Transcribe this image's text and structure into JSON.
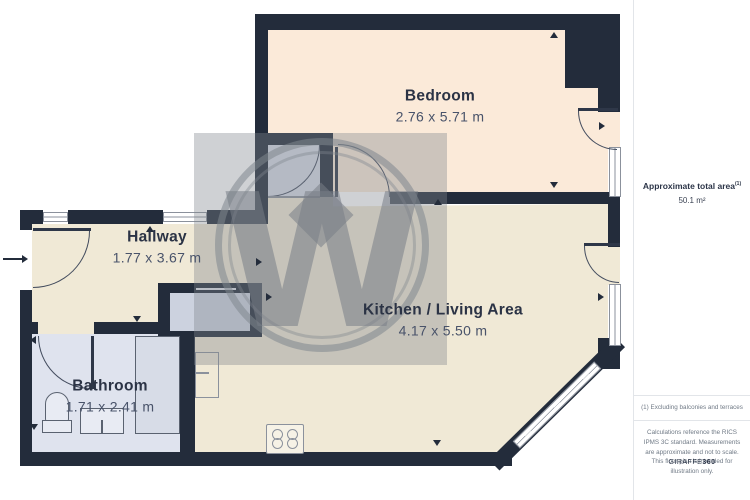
{
  "rooms": {
    "bedroom": {
      "name": "Bedroom",
      "dims": "2.76 x 5.71 m"
    },
    "hallway": {
      "name": "Hallway",
      "dims": "1.77 x 3.67 m"
    },
    "kitchen": {
      "name": "Kitchen / Living Area",
      "dims": "4.17 x 5.50 m"
    },
    "bathroom": {
      "name": "Bathroom",
      "dims": "1.71 x 2.41 m"
    }
  },
  "sidebar": {
    "total_area_label": "Approximate total area",
    "total_area_superscript": "(1)",
    "total_area_value": "50.1 m²",
    "footnote": "(1) Excluding balconies and terraces",
    "disclaimer": "Calculations reference the RICS IPMS 3C standard. Measurements are approximate and not to scale. This floor plan is intended for illustration only.",
    "brand_name": "GIRAFFE",
    "brand_suffix": "360"
  },
  "watermark": {
    "letter": "W"
  },
  "colors": {
    "wall": "#232c3b",
    "bedroom_fill": "#fbead9",
    "living_fill": "#f0e9d6",
    "wet_room_fill": "#dfe3ee",
    "watermark_grey": "#808690"
  }
}
